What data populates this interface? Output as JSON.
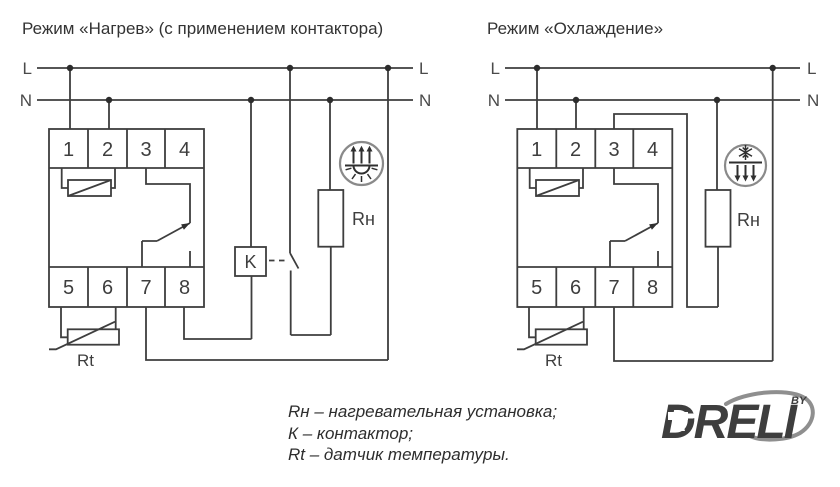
{
  "colors": {
    "line": "#3e3e3e",
    "text": "#333333",
    "icon_circle": "#8a8a8a",
    "logo_orange": "#F47B20",
    "logo_gray": "#8f8f8f"
  },
  "heating": {
    "title": "Режим «Нагрев» (с применением контактора)",
    "labels": {
      "l_left": "L",
      "n_left": "N",
      "l_right": "L",
      "n_right": "N"
    },
    "terminals_top": [
      "1",
      "2",
      "3",
      "4"
    ],
    "terminals_bottom": [
      "5",
      "6",
      "7",
      "8"
    ],
    "contactor": "K",
    "heater": "Rн",
    "sensor": "Rt"
  },
  "cooling": {
    "title": "Режим «Охлаждение»",
    "labels": {
      "l_left": "L",
      "n_left": "N",
      "l_right": "L",
      "n_right": "N"
    },
    "terminals_top": [
      "1",
      "2",
      "3",
      "4"
    ],
    "terminals_bottom": [
      "5",
      "6",
      "7",
      "8"
    ],
    "heater": "Rн",
    "sensor": "Rt"
  },
  "legend": {
    "line1": "Rн – нагревательная установка;",
    "line2": "К – контактор;",
    "line3": "Rt – датчик температуры."
  },
  "logo": {
    "brand": "DRELI",
    "by": "BY"
  }
}
